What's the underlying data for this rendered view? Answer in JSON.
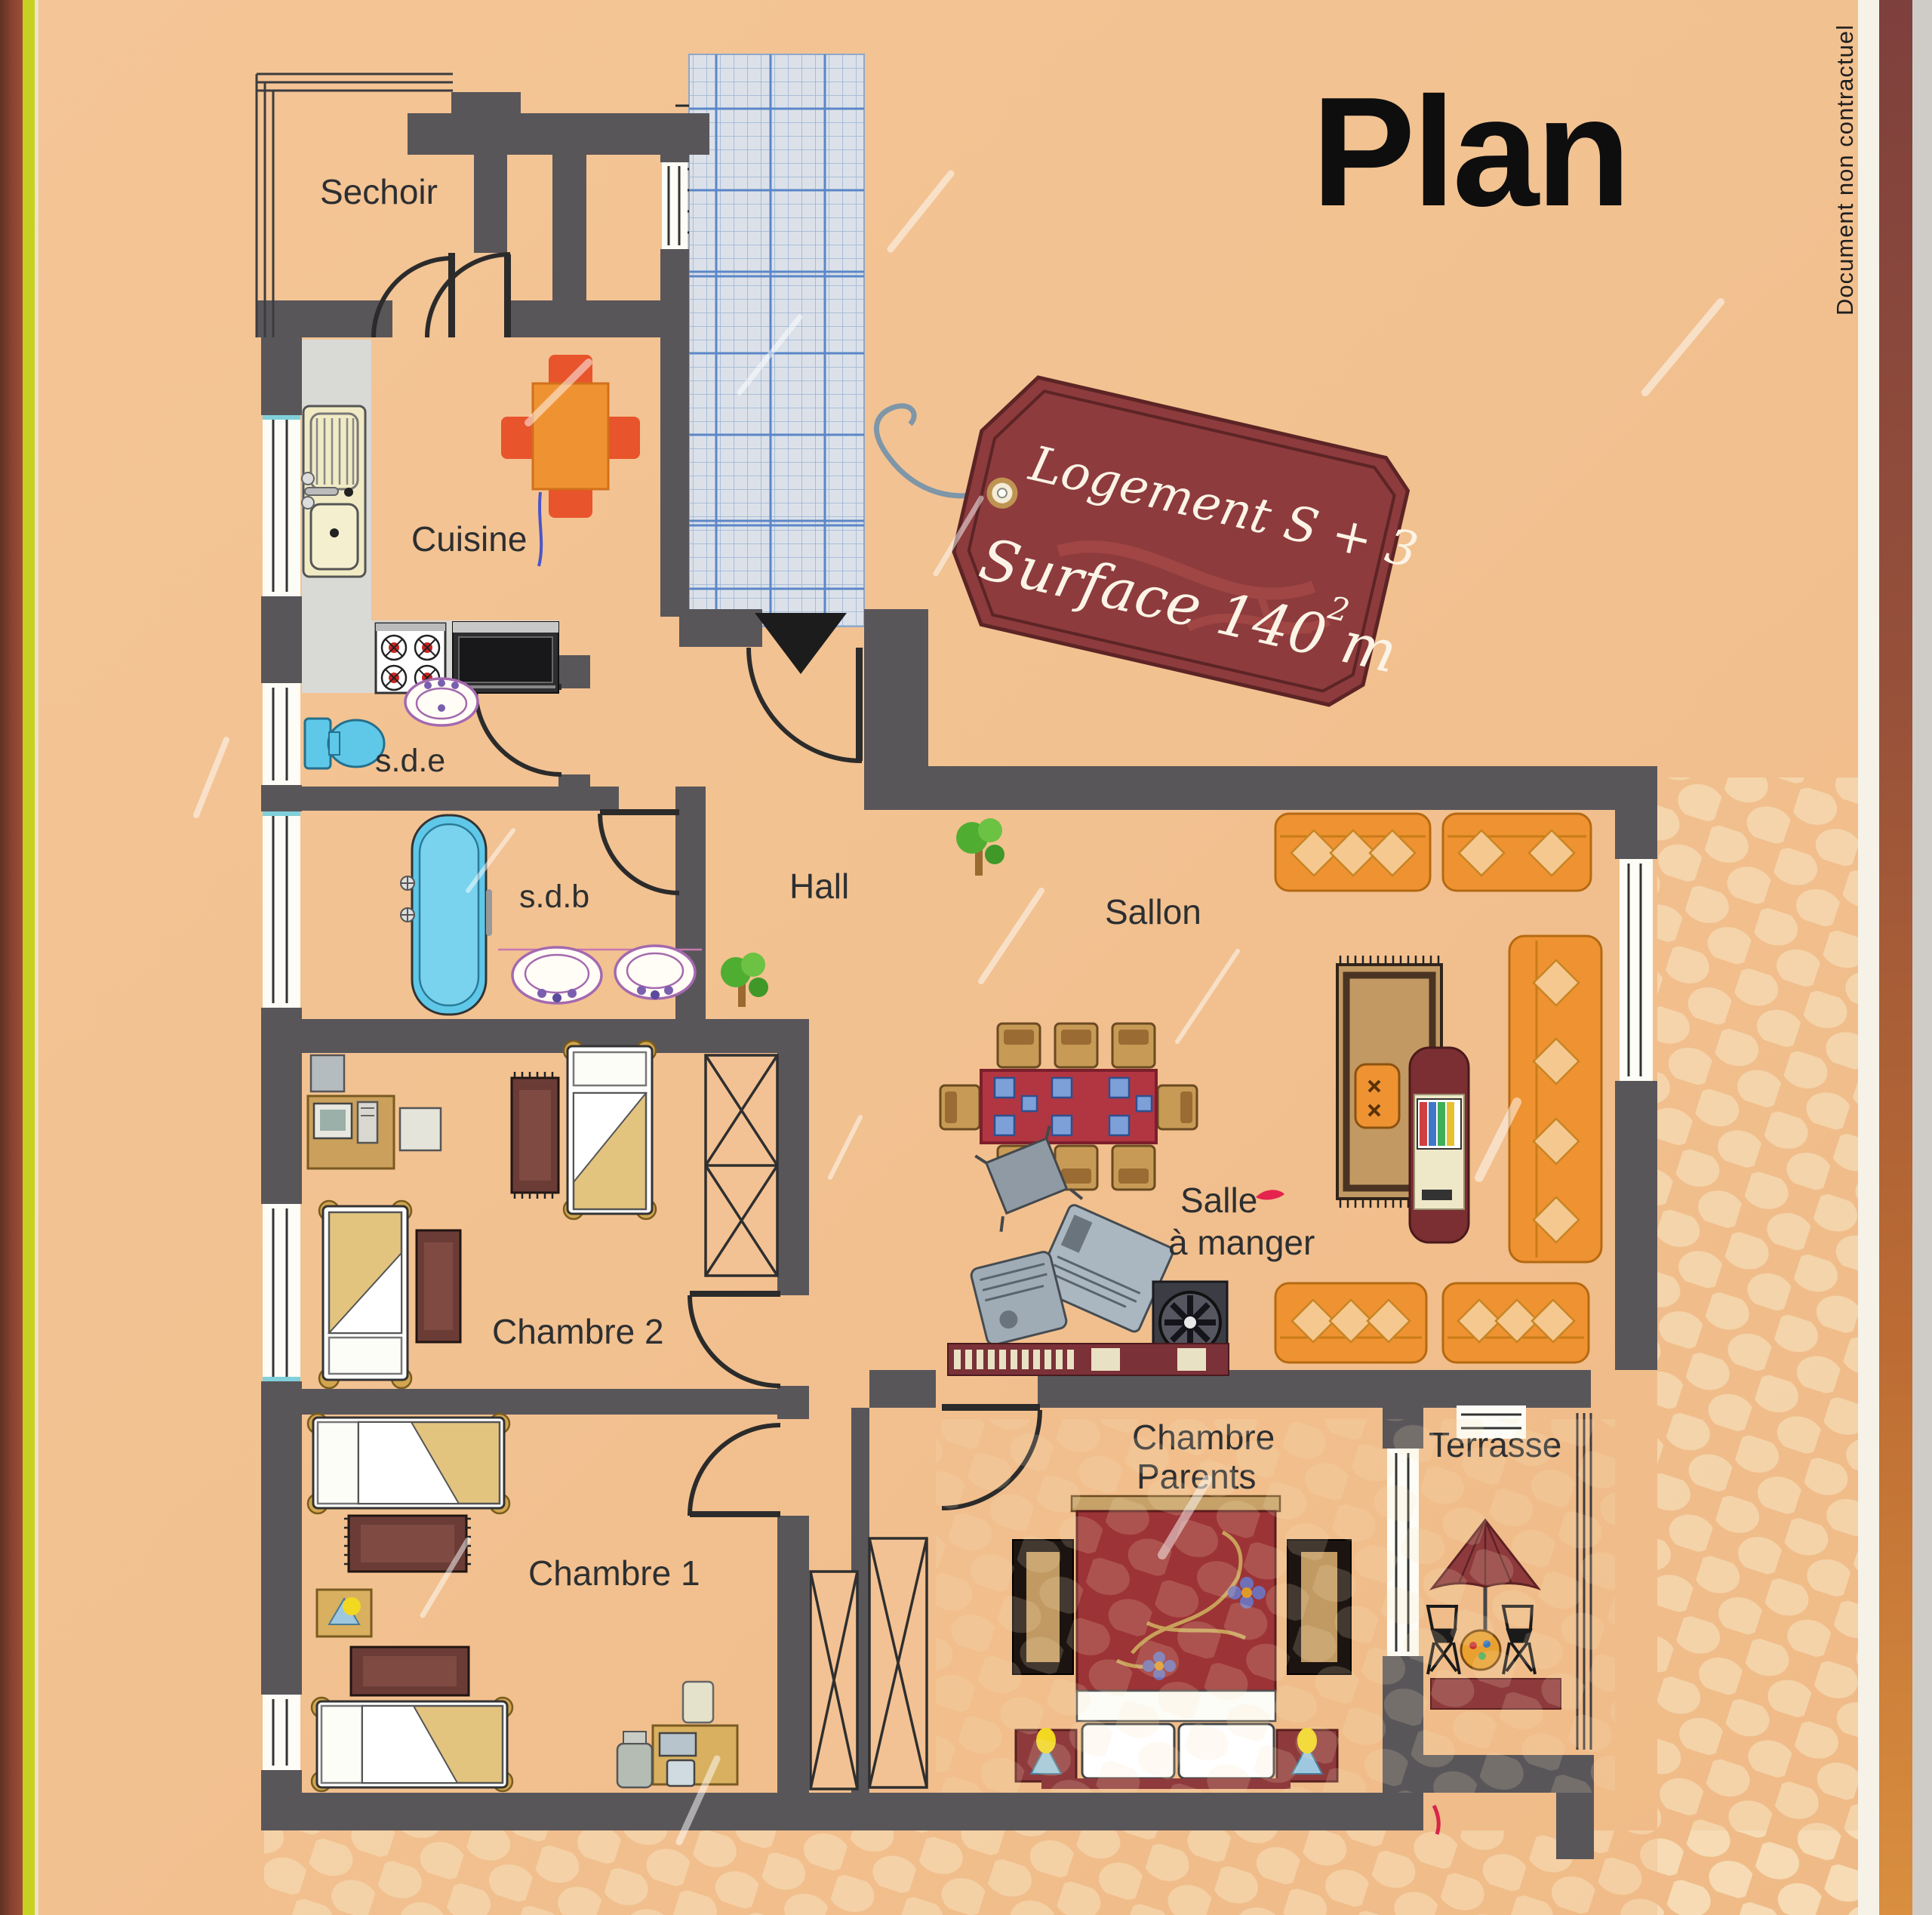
{
  "title": "Plan",
  "side_note": "Document non contractuel",
  "tag": {
    "line1": "Logement S + 3",
    "line2": "Surface 140 m",
    "sup": "2"
  },
  "rooms": {
    "sechoir": "Sechoir",
    "cuisine": "Cuisine",
    "sde": "s.d.e",
    "sdb": "s.d.b",
    "hall": "Hall",
    "sallon": "Sallon",
    "salle1": "Salle",
    "salle2": "à manger",
    "chambre2": "Chambre 2",
    "chambre1": "Chambre 1",
    "parents1": "Chambre",
    "parents2": "Parents",
    "terrasse": "Terrasse"
  },
  "colors": {
    "background": "#f3c294",
    "wall": "#59565a",
    "tag_red": "#8d3b3d",
    "tile_blue": "#6d9cd4",
    "furniture_orange": "#ef9232",
    "fixture_cyan": "#5fc8e8",
    "edge_yellow": "#c6d120"
  }
}
